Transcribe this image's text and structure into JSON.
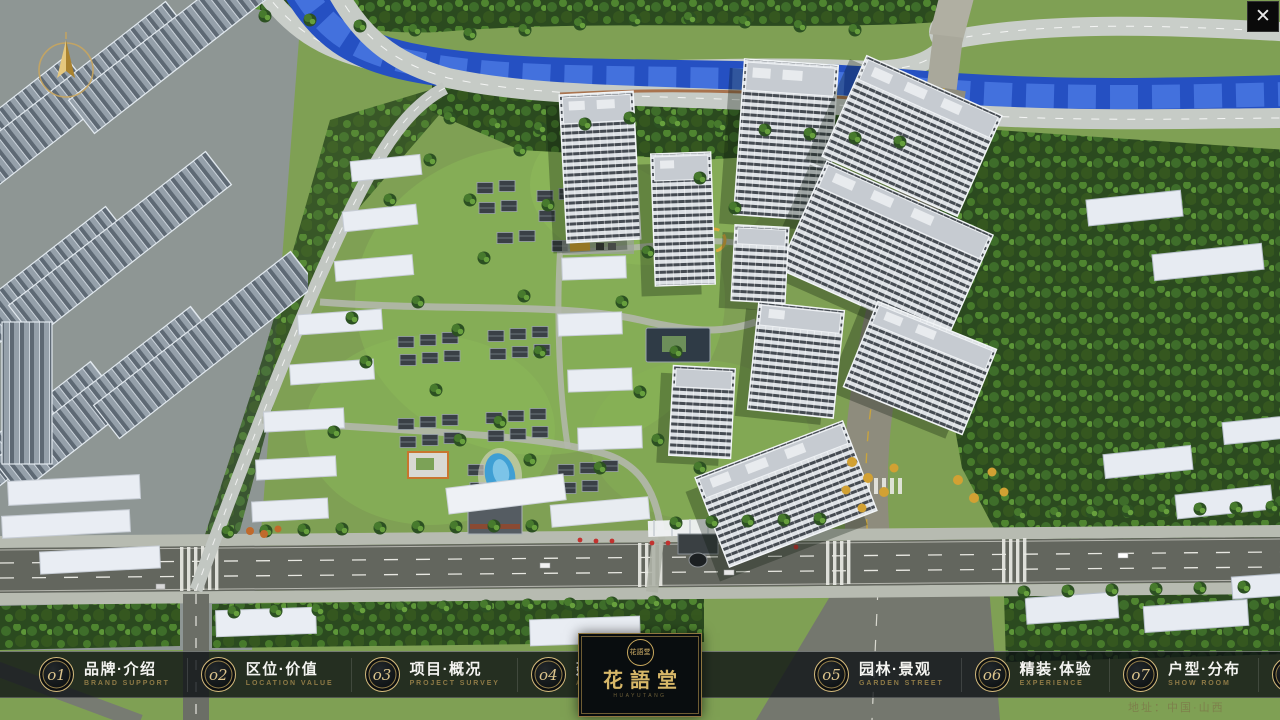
{
  "window": {
    "close_glyph": "✕"
  },
  "colors": {
    "brand_gold": "#c9ad6e",
    "bar_bg": "#0d1114",
    "label_text": "#f4f4f1",
    "label_sub": "#8e7a46",
    "river_blue": "#2a55c6"
  },
  "navbar": {
    "items": [
      {
        "num": "o1",
        "cn": "品牌·介绍",
        "en": "BRAND SUPPORT"
      },
      {
        "num": "o2",
        "cn": "区位·价值",
        "en": "LOCATION VALUE"
      },
      {
        "num": "o3",
        "cn": "项目·概况",
        "en": "PROJECT SURVEY"
      },
      {
        "num": "o4",
        "cn": "建筑·鉴赏",
        "en": "APPRECIATION"
      },
      {
        "num": "o5",
        "cn": "园林·景观",
        "en": "GARDEN STREET"
      },
      {
        "num": "o6",
        "cn": "精装·体验",
        "en": "EXPERIENCE"
      },
      {
        "num": "o7",
        "cn": "户型·分布",
        "en": "SHOW ROOM"
      },
      {
        "num": "o8",
        "cn": "一房·一景",
        "en": "COMMUNITY"
      }
    ],
    "logo": {
      "seal": "花語堂",
      "title": "花語堂",
      "subtitle": "HUAYUTANG"
    },
    "address": "地址：中国·山西"
  }
}
